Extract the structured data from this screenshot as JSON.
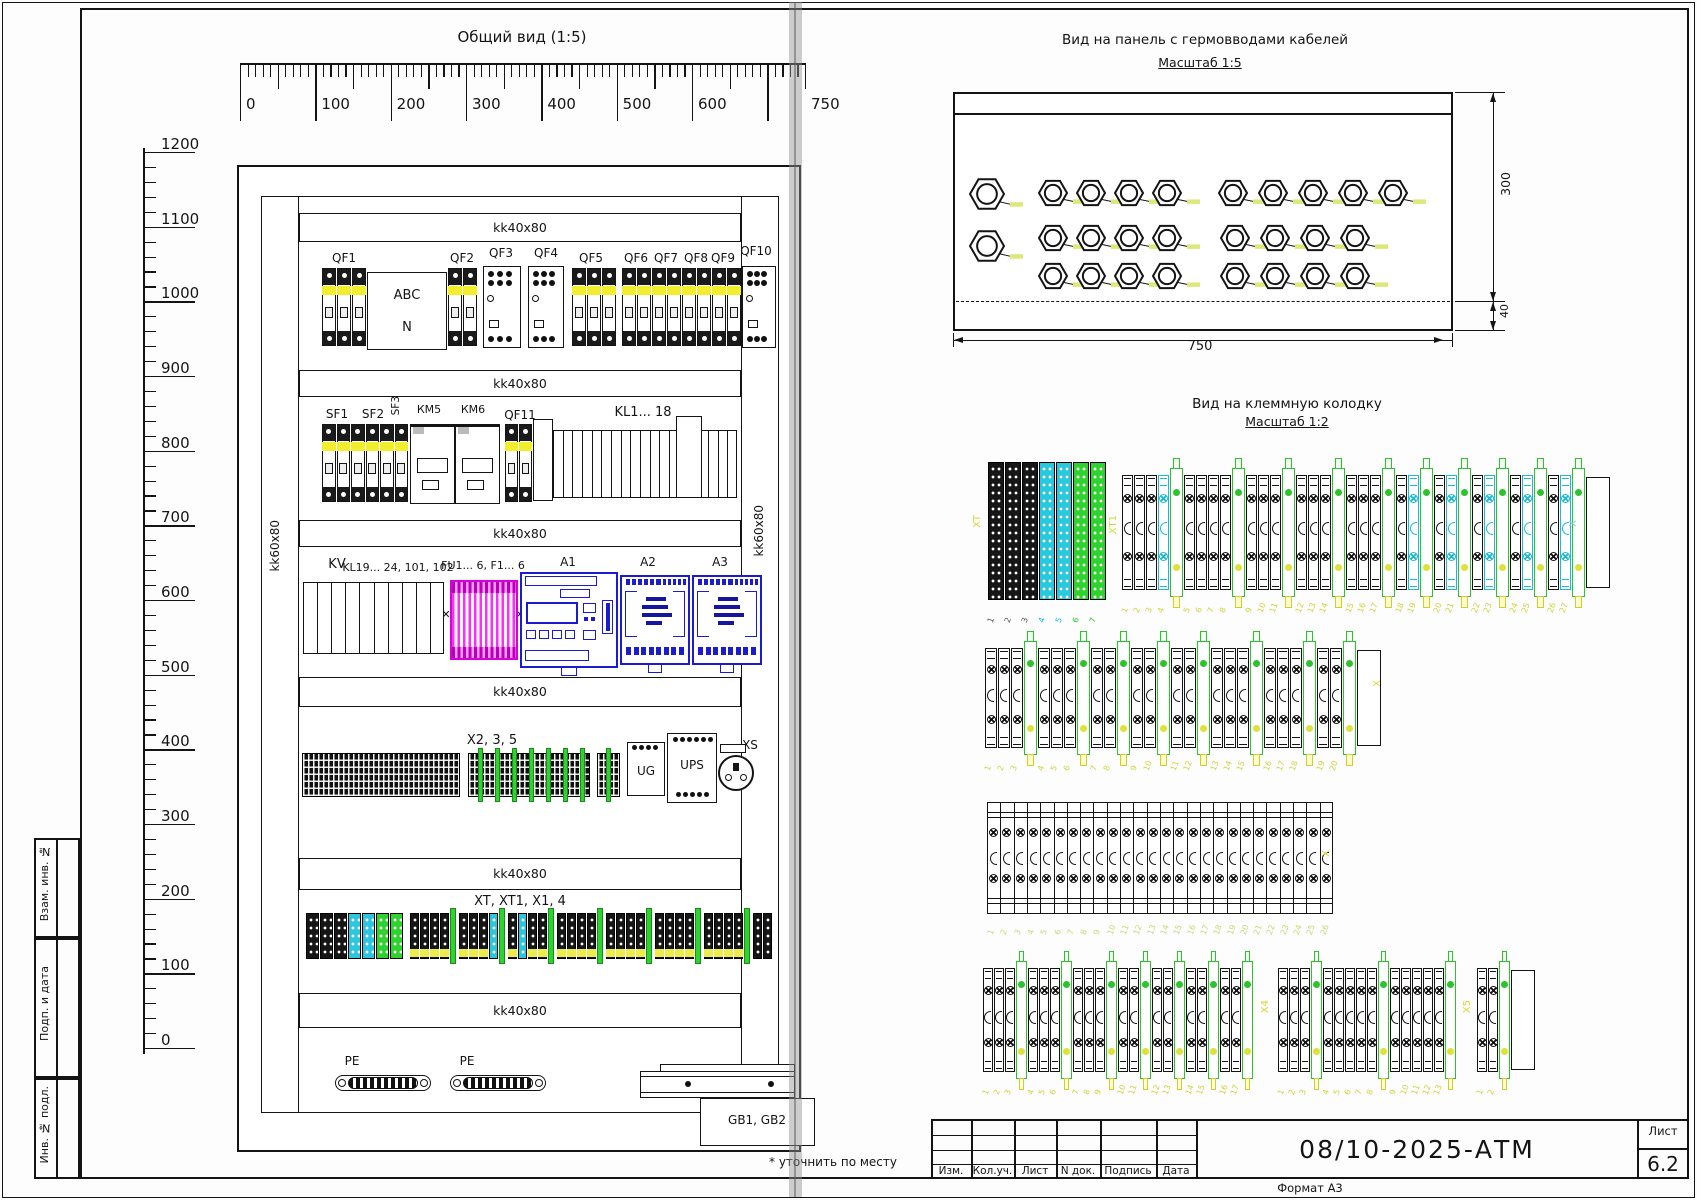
{
  "drawing": {
    "general_view": {
      "title": "Общий вид (1:5)",
      "duct_label": "kk40x80",
      "rail_label": "kk60x80",
      "h_ruler": {
        "values": [
          0,
          100,
          200,
          300,
          400,
          500,
          600,
          750
        ],
        "labels": [
          "0",
          "100",
          "200",
          "300",
          "400",
          "500",
          "600",
          "750"
        ]
      },
      "v_ruler": {
        "values": [
          1200,
          1100,
          1000,
          900,
          800,
          700,
          600,
          500,
          400,
          300,
          200,
          100,
          0
        ],
        "labels": [
          "1200",
          "1100",
          "1000",
          "900",
          "800",
          "700",
          "600",
          "500",
          "400",
          "300",
          "200",
          "100",
          "0"
        ]
      },
      "components": {
        "qf1": "QF1",
        "qf2": "QF2",
        "qf3": "QF3",
        "qf4": "QF4",
        "qf5": "QF5",
        "qf6": "QF6",
        "qf7": "QF7",
        "qf8": "QF8",
        "qf9": "QF9",
        "qf10": "QF10",
        "phase_top": "ABC",
        "phase_bottom": "N",
        "sf1": "SF1",
        "sf2": "SF2",
        "sf3": "SF3",
        "km5": "КМ5",
        "km6": "КМ6",
        "qf11": "QF11",
        "kl_strip": "KL1... 18",
        "kv": "KV",
        "kl_strip2": "KL19... 24, 101, 102",
        "fuses": "FU1... 6, F1... 6",
        "a1": "A1",
        "a2": "A2",
        "a3": "A3",
        "x_strip": "X2, 3, 5",
        "ug": "UG",
        "ups": "UPS",
        "xs": "XS",
        "xt_strip": "XT, XT1, X1, 4",
        "pe1": "PE",
        "pe2": "PE",
        "gb": "GB1, GB2"
      },
      "footnote": "* уточнить по месту"
    },
    "gland_view": {
      "title": "Вид на панель с гермовводами кабелей",
      "scale": "Масштаб 1:5",
      "note": "Не занимать",
      "dim_width": "750",
      "dim_height": "300",
      "dim_bottom": "40"
    },
    "terminal_view": {
      "title": "Вид на клеммную колодку",
      "scale": "Масштаб 1:2",
      "group_labels": {
        "xt": "XT",
        "xt1": "XT1",
        "x": "X",
        "x4": "X4",
        "x5": "X5"
      },
      "row1_big_numbers": [
        "1",
        "2",
        "3",
        "4",
        "5",
        "6",
        "7"
      ],
      "numbering": {
        "row1_small": [
          1,
          30
        ],
        "row2": [
          1,
          20
        ],
        "row3": [
          1,
          26
        ],
        "row4_seg1": [
          1,
          17
        ],
        "row4_seg2": [
          1,
          13
        ],
        "row4_seg3": [
          1,
          2
        ]
      }
    },
    "side_stamp": [
      "Взам. инв. №",
      "Подп. и дата",
      "Инв. № подл."
    ],
    "title_block": {
      "columns": [
        "Изм.",
        "Кол.уч.",
        "Лист",
        "N док.",
        "Подпись",
        "Дата"
      ],
      "doc_number": "08/10-2025-АТМ",
      "sheet_label": "Лист",
      "sheet_number": "6.2",
      "format_label": "Формат А3"
    }
  }
}
